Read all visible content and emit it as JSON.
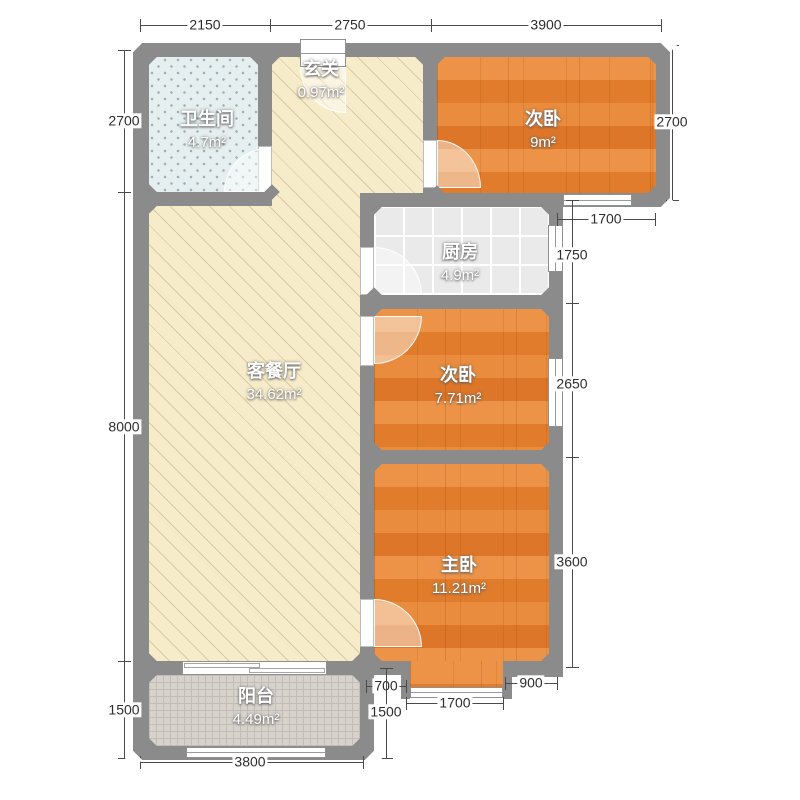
{
  "plan_title": "户型图",
  "rooms": {
    "bathroom": {
      "name": "卫生间",
      "area": "4.7m²"
    },
    "entry": {
      "name": "玄关",
      "area": "0.97m²"
    },
    "bedroom1": {
      "name": "次卧",
      "area": "9m²"
    },
    "kitchen": {
      "name": "厨房",
      "area": "4.9m²"
    },
    "bedroom2": {
      "name": "次卧",
      "area": "7.71m²"
    },
    "living": {
      "name": "客餐厅",
      "area": "34.62m²"
    },
    "master": {
      "name": "主卧",
      "area": "11.21m²"
    },
    "balcony": {
      "name": "阳台",
      "area": "4.49m²"
    }
  },
  "dimensions": {
    "top": [
      "2150",
      "2750",
      "3900"
    ],
    "left": [
      "2700",
      "8000",
      "1500"
    ],
    "right_inner": [
      "1750",
      "2650",
      "3600"
    ],
    "right_bedroom1": "2700",
    "bedroom1_window": "1700",
    "master_bottom": [
      "700",
      "1700",
      "900"
    ],
    "balcony_right": "1500",
    "bottom": "3800"
  },
  "colors": {
    "wall": "#8b8b8b",
    "wood_floor": "#e5853a",
    "living_floor": "#f7ecca",
    "bathroom_floor": "#e6efef",
    "kitchen_floor": "#eaeaea",
    "balcony_floor": "#d7d3cc",
    "dimension_text": "#2d2d2d",
    "label_text": "#ffffff"
  }
}
